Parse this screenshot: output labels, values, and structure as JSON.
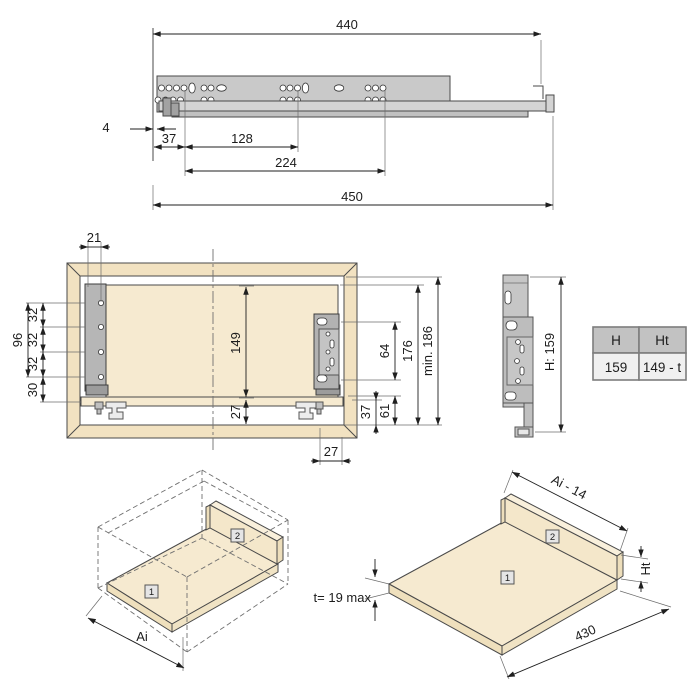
{
  "colors": {
    "panel_beige": "#f6ead0",
    "frame_tan": "#f2e2c1",
    "metal_gray": "#c9c9c9",
    "table_header_bg": "#c2c2c2",
    "table_body_bg": "#f0f0f0"
  },
  "side_view": {
    "d_length_top": "440",
    "d_front_gap": "4",
    "d_first_hole": "37",
    "d_hole_pitch": "128",
    "d_hole_pitch2": "224",
    "d_length_total": "450"
  },
  "front_view": {
    "d_hole_offset": "21",
    "d_pitch_1": "32",
    "d_pitch_2": "32",
    "d_pitch_3": "32",
    "d_group": "96",
    "d_bottom": "30",
    "d_back_height": "149",
    "d_under_clearance": "27",
    "d_bracket_span": "64",
    "d_drawer_height": "176",
    "d_min_space": "min. 186",
    "d_rear_h1": "61",
    "d_rear_h2": "37",
    "d_rear_offset": "27"
  },
  "profile_view": {
    "d_height": "H: 159"
  },
  "spec_table": {
    "headers": [
      "H",
      "Ht"
    ],
    "values": [
      "159",
      "149 - t"
    ]
  },
  "iso_cabinet": {
    "tag_bottom": "1",
    "tag_back": "2",
    "d_width": "Ai"
  },
  "iso_panels": {
    "tag_bottom": "1",
    "tag_back": "2",
    "d_width": "Ai - 14",
    "d_back_height": "Ht",
    "d_depth": "430",
    "d_thickness": "t= 19 max"
  }
}
